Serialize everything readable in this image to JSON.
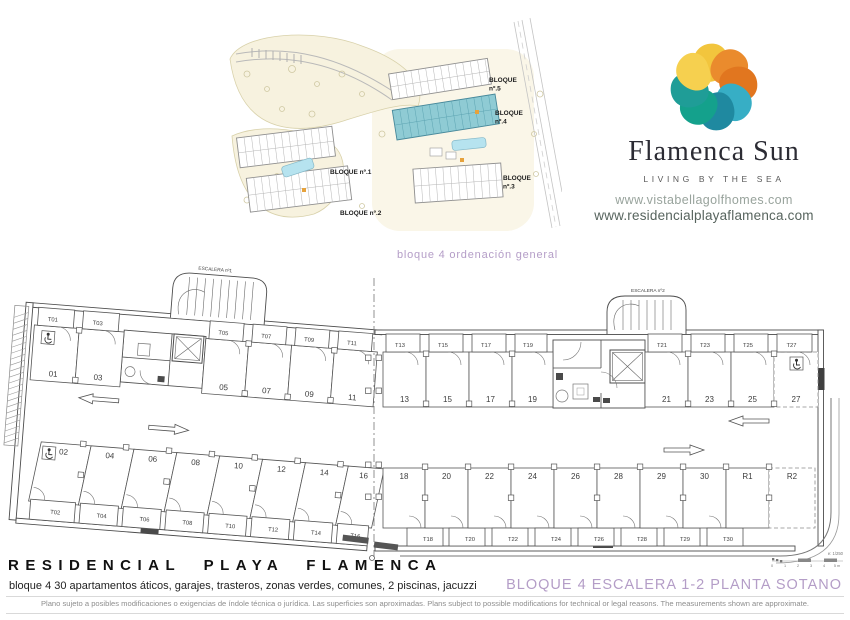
{
  "brand": {
    "name": "Flamenca Sun",
    "tagline": "LIVING BY THE SEA",
    "logo_colors": [
      "#f2c53d",
      "#ea8b2d",
      "#e1761f",
      "#37aec5",
      "#1f89a0",
      "#14a18c",
      "#1f9d97",
      "#f6d04f"
    ]
  },
  "websites": [
    "www.vistabellagolfhomes.com",
    "www.residencialplayaflamenca.com"
  ],
  "site_plan": {
    "caption": "bloque 4 ordenación general",
    "labels": [
      "BLOQUE nº.1",
      "BLOQUE nº.2",
      "BLOQUE nº.3",
      "BLOQUE nº.4",
      "BLOQUE nº.5"
    ],
    "highlight_color": "#8fcbd4"
  },
  "floor_plan": {
    "stair_labels": [
      "ESCALERA nº1",
      "ESCALERA nº2"
    ],
    "top_row": {
      "storage": [
        "T01",
        "T03",
        "T05",
        "T07",
        "T09",
        "T11",
        "T13",
        "T15",
        "T17",
        "T19",
        "T21",
        "T23",
        "T25",
        "T27"
      ],
      "stalls": [
        "01",
        "03",
        "05",
        "07",
        "09",
        "11",
        "13",
        "15",
        "17",
        "19",
        "21",
        "23",
        "25",
        "27"
      ]
    },
    "bottom_row": {
      "stalls": [
        "02",
        "04",
        "06",
        "08",
        "10",
        "12",
        "14",
        "16",
        "18",
        "20",
        "22",
        "24",
        "26",
        "28",
        "29",
        "30",
        "R1",
        "R2"
      ],
      "storage": [
        "T02",
        "T04",
        "T06",
        "T08",
        "T10",
        "T12",
        "T14",
        "T16",
        "T18",
        "T20",
        "T22",
        "T24",
        "T26",
        "T28",
        "T29",
        "T30"
      ]
    },
    "handicap_stalls": [
      "01",
      "02",
      "27"
    ],
    "dashed_stalls": [
      "27",
      "R2"
    ],
    "scale": {
      "label": "e: 1/250",
      "ticks": [
        "0",
        "1",
        "2",
        "3",
        "4",
        "5 m"
      ]
    }
  },
  "footer": {
    "title": "RESIDENCIAL PLAYA FLAMENCA",
    "subtitle": "bloque 4 30 apartamentos áticos, garajes, trasteros, zonas verdes, comunes, 2 piscinas, jacuzzi",
    "sheet_title": "BLOQUE 4 ESCALERA 1-2 PLANTA SOTANO",
    "disclaimer": "Plano sujeto a posibles modificaciones o exigencias de índole técnica o jurídica. Las superficies son aproximadas. Plans subject to possible modifications for technical or legal reasons. The measurements shown are approximate."
  }
}
